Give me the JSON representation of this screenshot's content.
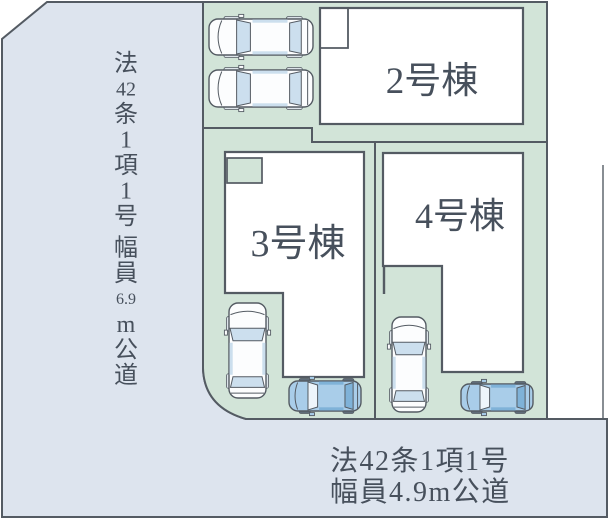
{
  "plan": {
    "title_hint": "site plan with 3 building lots and roads",
    "buildings": [
      {
        "id": "2",
        "label": "2号棟"
      },
      {
        "id": "3",
        "label": "3号棟"
      },
      {
        "id": "4",
        "label": "4号棟"
      }
    ],
    "roads": {
      "left_segments": [
        "法",
        "42",
        "条",
        "1",
        "項",
        "1",
        "号",
        "幅",
        "員",
        "6.9",
        "m",
        "公",
        "道"
      ],
      "bottom_line1": "法42条1項1号",
      "bottom_line2": "幅員4.9m公道"
    },
    "cars": [
      {
        "name": "car-parking-top-1",
        "scheme": "white",
        "dir": "left",
        "x": 208,
        "y": 17,
        "w": 106,
        "h": 40
      },
      {
        "name": "car-parking-top-2",
        "scheme": "white",
        "dir": "left",
        "x": 208,
        "y": 68,
        "w": 106,
        "h": 41
      },
      {
        "name": "car-lot3-white",
        "scheme": "white",
        "dir": "up",
        "x": 227,
        "y": 302,
        "w": 41,
        "h": 97
      },
      {
        "name": "car-lot3-blue",
        "scheme": "blue",
        "dir": "left",
        "x": 288,
        "y": 379,
        "w": 74,
        "h": 34
      },
      {
        "name": "car-lot4-white",
        "scheme": "white",
        "dir": "up",
        "x": 390,
        "y": 316,
        "w": 38,
        "h": 97
      },
      {
        "name": "car-lot4-blue",
        "scheme": "blue",
        "dir": "left",
        "x": 460,
        "y": 382,
        "w": 74,
        "h": 31
      }
    ],
    "colors": {
      "road": "#dde4ee",
      "lot_green": "#d2e4d8",
      "building_white": "#ffffff",
      "outline": "#545b63",
      "text": "#47505c",
      "car_blue_body": "#a9cde9",
      "car_blue_window": "#7fb2d8",
      "car_white_window": "#ccdfee"
    }
  }
}
